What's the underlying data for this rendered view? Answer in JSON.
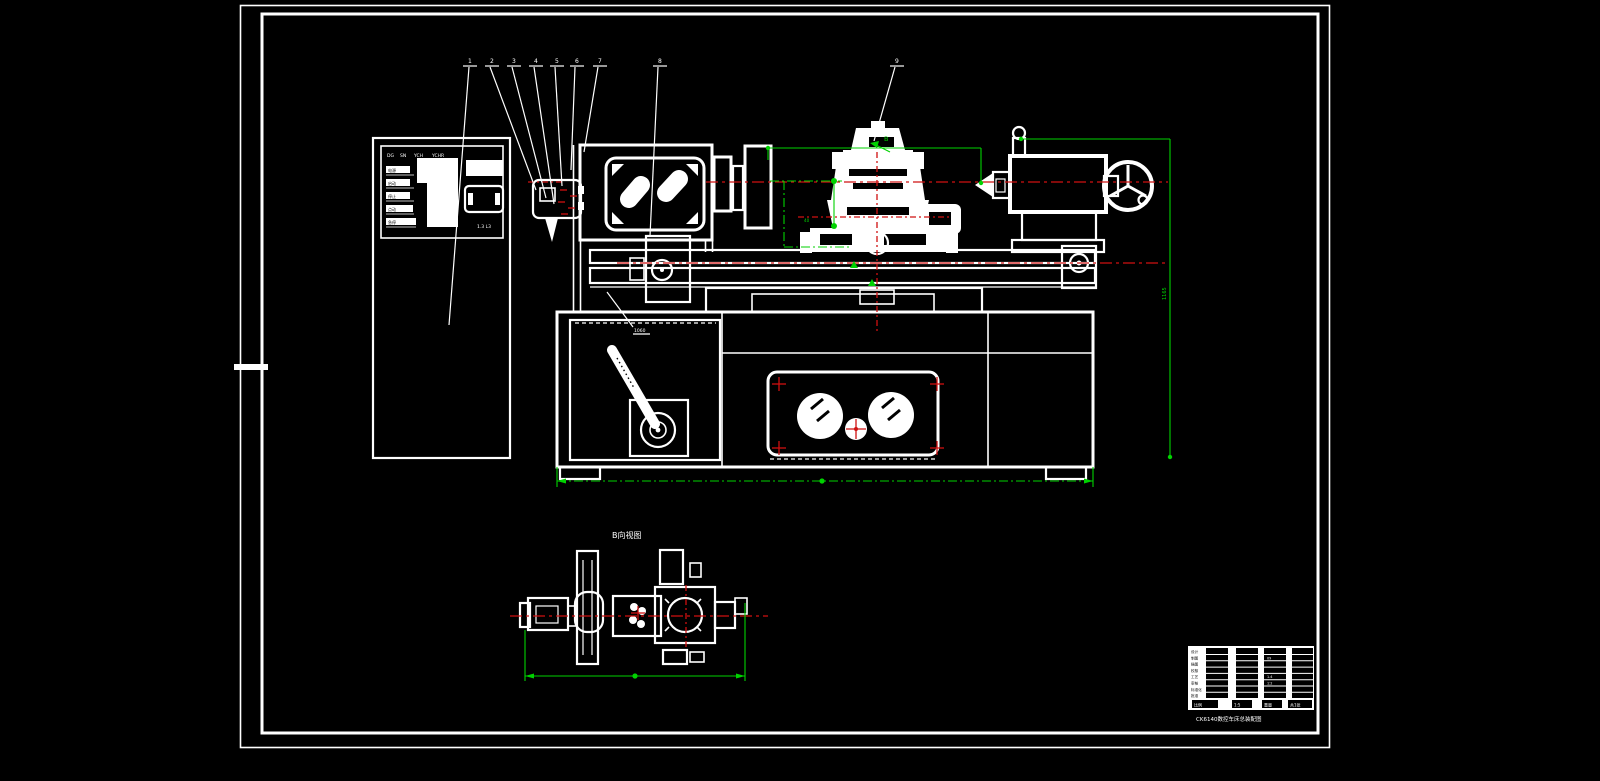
{
  "colors": {
    "background": "#000000",
    "lines": "#ffffff",
    "centerline_red": "#cf1010",
    "dimension_green": "#00d200"
  },
  "balloons": [
    {
      "label": "1"
    },
    {
      "label": "2"
    },
    {
      "label": "3"
    },
    {
      "label": "4"
    },
    {
      "label": "5"
    },
    {
      "label": "6"
    },
    {
      "label": "7"
    },
    {
      "label": "8"
    },
    {
      "label": "9"
    }
  ],
  "view_b": {
    "title": "B向视图",
    "direction_label": "B"
  },
  "dimensions": {
    "right_vertical": "1165",
    "leader_note": "1060",
    "toolpost_note": "40"
  },
  "control_panel": {
    "top_labels": [
      "DG",
      "SN",
      "YCH",
      "YCHR"
    ],
    "buttons": [
      "电源",
      "启动",
      "停止",
      "点动",
      "急停"
    ],
    "footer": "1.3  L3"
  },
  "title_block": {
    "left_rows": [
      "设计",
      "制图",
      "描图",
      "校核",
      "工艺",
      "审核",
      "标准化",
      "批准"
    ],
    "inline_values": [
      "09",
      "1.4",
      "1:2"
    ],
    "bottom_cells": [
      "比例",
      "1:5",
      "重量",
      "共1张"
    ],
    "caption": "CK6140数控车床总装配图"
  }
}
